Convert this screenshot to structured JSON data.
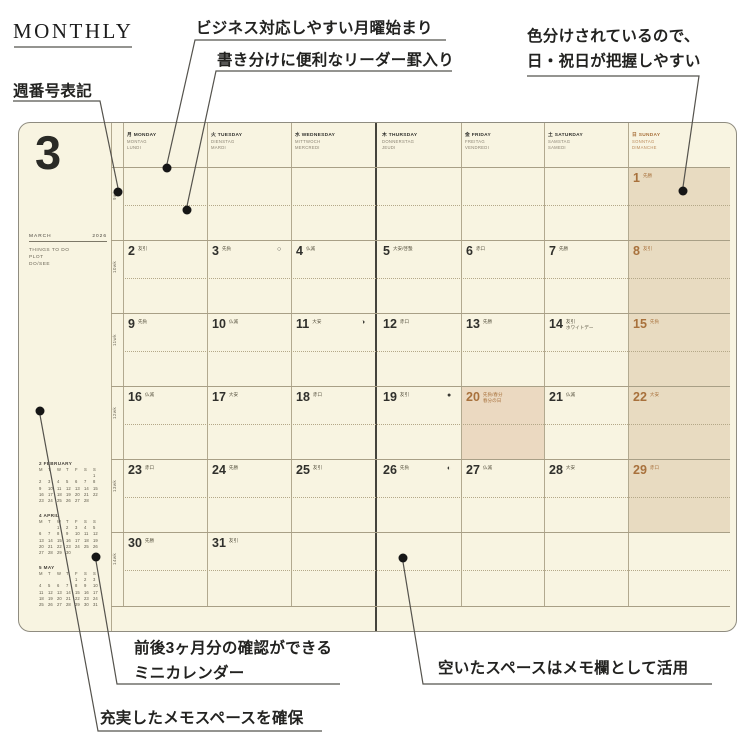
{
  "header": {
    "title": "MONTHLY"
  },
  "annotations": {
    "week_number": "週番号表記",
    "monday_start": "ビジネス対応しやすい月曜始まり",
    "leader_rule": "書き分けに便利なリーダー罫入り",
    "color_coded_line1": "色分けされているので、",
    "color_coded_line2": "日・祝日が把握しやすい",
    "mini_calendar_line1": "前後3ヶ月分の確認ができる",
    "mini_calendar_line2": "ミニカレンダー",
    "memo_space": "充実したメモスペースを確保",
    "empty_space": "空いたスペースはメモ欄として活用"
  },
  "planner": {
    "month_number": "3",
    "month_name": "MARCH",
    "year": "2026",
    "todo_lines": [
      "THINGS TO DO",
      "PLOT",
      "DO/SEE"
    ],
    "week_labels": [
      "9wk",
      "10wk",
      "11wk",
      "12wk",
      "13wk",
      "14wk"
    ],
    "day_headers": [
      {
        "jp": "月",
        "en": "MONDAY",
        "de": "MONTAG",
        "fr": "LUNDI"
      },
      {
        "jp": "火",
        "en": "TUESDAY",
        "de": "DIENSTAG",
        "fr": "MARDI"
      },
      {
        "jp": "水",
        "en": "WEDNESDAY",
        "de": "MITTWOCH",
        "fr": "MERCREDI"
      },
      {
        "jp": "木",
        "en": "THURSDAY",
        "de": "DONNERSTAG",
        "fr": "JEUDI"
      },
      {
        "jp": "金",
        "en": "FRIDAY",
        "de": "FREITAG",
        "fr": "VENDREDI"
      },
      {
        "jp": "土",
        "en": "SATURDAY",
        "de": "SAMSTAG",
        "fr": "SAMEDI"
      },
      {
        "jp": "日",
        "en": "SUNDAY",
        "de": "SONNTAG",
        "fr": "DIMANCHE",
        "sunday": true
      }
    ],
    "weeks": [
      {
        "days": [
          null,
          null,
          null,
          null,
          null,
          null,
          {
            "date": "1",
            "rokuyo": "先勝"
          }
        ]
      },
      {
        "days": [
          {
            "date": "2",
            "rokuyo": "友引"
          },
          {
            "date": "3",
            "rokuyo": "先負",
            "moon": "○"
          },
          {
            "date": "4",
            "rokuyo": "仏滅"
          },
          {
            "date": "5",
            "rokuyo": "大安/啓蟄"
          },
          {
            "date": "6",
            "rokuyo": "赤口"
          },
          {
            "date": "7",
            "rokuyo": "先勝"
          },
          {
            "date": "8",
            "rokuyo": "友引"
          }
        ]
      },
      {
        "days": [
          {
            "date": "9",
            "rokuyo": "先負"
          },
          {
            "date": "10",
            "rokuyo": "仏滅"
          },
          {
            "date": "11",
            "rokuyo": "大安",
            "moon": "◑"
          },
          {
            "date": "12",
            "rokuyo": "赤口"
          },
          {
            "date": "13",
            "rokuyo": "先勝"
          },
          {
            "date": "14",
            "rokuyo": "友引",
            "note": "ホワイトデー"
          },
          {
            "date": "15",
            "rokuyo": "先負"
          }
        ]
      },
      {
        "days": [
          {
            "date": "16",
            "rokuyo": "仏滅"
          },
          {
            "date": "17",
            "rokuyo": "大安"
          },
          {
            "date": "18",
            "rokuyo": "赤口"
          },
          {
            "date": "19",
            "rokuyo": "友引",
            "moon": "●"
          },
          {
            "date": "20",
            "rokuyo": "先負/春分",
            "note": "春分の日",
            "holiday": true
          },
          {
            "date": "21",
            "rokuyo": "仏滅"
          },
          {
            "date": "22",
            "rokuyo": "大安"
          }
        ]
      },
      {
        "days": [
          {
            "date": "23",
            "rokuyo": "赤口"
          },
          {
            "date": "24",
            "rokuyo": "先勝"
          },
          {
            "date": "25",
            "rokuyo": "友引"
          },
          {
            "date": "26",
            "rokuyo": "先負",
            "moon": "◐"
          },
          {
            "date": "27",
            "rokuyo": "仏滅"
          },
          {
            "date": "28",
            "rokuyo": "大安"
          },
          {
            "date": "29",
            "rokuyo": "赤口"
          }
        ]
      },
      {
        "days": [
          {
            "date": "30",
            "rokuyo": "先勝"
          },
          {
            "date": "31",
            "rokuyo": "友引"
          },
          null,
          null,
          null,
          null,
          null
        ]
      }
    ],
    "mini_calendars": [
      {
        "title": "2 FEBRUARY",
        "dow": [
          "M",
          "T",
          "W",
          "T",
          "F",
          "S",
          "S"
        ],
        "rows": [
          [
            "",
            "",
            "",
            "",
            "",
            "",
            "1"
          ],
          [
            "2",
            "3",
            "4",
            "5",
            "6",
            "7",
            "8"
          ],
          [
            "9",
            "10",
            "11",
            "12",
            "13",
            "14",
            "15"
          ],
          [
            "16",
            "17",
            "18",
            "19",
            "20",
            "21",
            "22"
          ],
          [
            "23",
            "24",
            "25",
            "26",
            "27",
            "28",
            ""
          ]
        ],
        "highlight": [
          "1",
          "8",
          "11",
          "15",
          "22",
          "23"
        ]
      },
      {
        "title": "4 APRIL",
        "dow": [
          "M",
          "T",
          "W",
          "T",
          "F",
          "S",
          "S"
        ],
        "rows": [
          [
            "",
            "",
            "1",
            "2",
            "3",
            "4",
            "5"
          ],
          [
            "6",
            "7",
            "8",
            "9",
            "10",
            "11",
            "12"
          ],
          [
            "13",
            "14",
            "15",
            "16",
            "17",
            "18",
            "19"
          ],
          [
            "20",
            "21",
            "22",
            "23",
            "24",
            "25",
            "26"
          ],
          [
            "27",
            "28",
            "29",
            "30",
            "",
            "",
            ""
          ]
        ],
        "highlight": [
          "5",
          "12",
          "19",
          "26",
          "29"
        ]
      },
      {
        "title": "5 MAY",
        "dow": [
          "M",
          "T",
          "W",
          "T",
          "F",
          "S",
          "S"
        ],
        "rows": [
          [
            "",
            "",
            "",
            "",
            "1",
            "2",
            "3"
          ],
          [
            "4",
            "5",
            "6",
            "7",
            "8",
            "9",
            "10"
          ],
          [
            "11",
            "12",
            "13",
            "14",
            "15",
            "16",
            "17"
          ],
          [
            "18",
            "19",
            "20",
            "21",
            "22",
            "23",
            "24"
          ],
          [
            "25",
            "26",
            "27",
            "28",
            "29",
            "30",
            "31"
          ]
        ],
        "highlight": [
          "3",
          "4",
          "5",
          "6",
          "10",
          "17",
          "24",
          "31"
        ]
      }
    ],
    "colors": {
      "paper": "#f8f4e1",
      "sunday_shade": "#e8dbc1",
      "holiday_shade": "#ebd9c1",
      "accent_brown": "#a8713c",
      "ink": "#30302c",
      "sub_gray": "#8a8272",
      "grid": "#b2a98f"
    }
  }
}
